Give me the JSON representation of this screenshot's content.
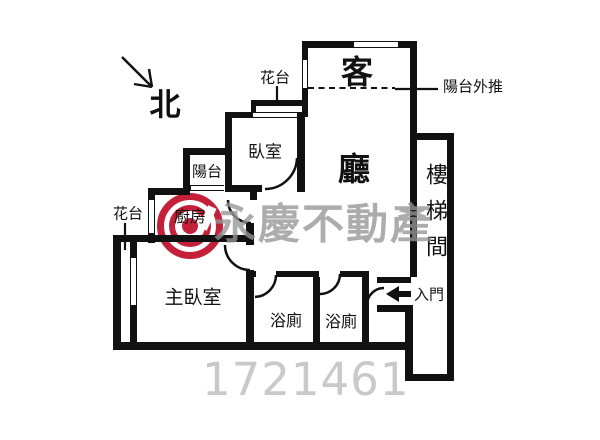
{
  "plan": {
    "north": "北",
    "labels": {
      "flower_top": "花台",
      "flower_left": "花台",
      "balcony_pushed_out": "陽台外推",
      "entrance": "入門"
    },
    "rooms": {
      "living": [
        "客",
        "廳"
      ],
      "bedroom": "臥室",
      "balcony": "陽台",
      "kitchen": "廚房",
      "master_bedroom": "主臥室",
      "baths": [
        "浴廁",
        "浴廁"
      ],
      "stairwell": "樓梯間"
    }
  },
  "watermark": {
    "brand": "永慶不動產",
    "listing_id": "1721461",
    "brand_color": "#c5203a",
    "text_color": "#969696"
  }
}
